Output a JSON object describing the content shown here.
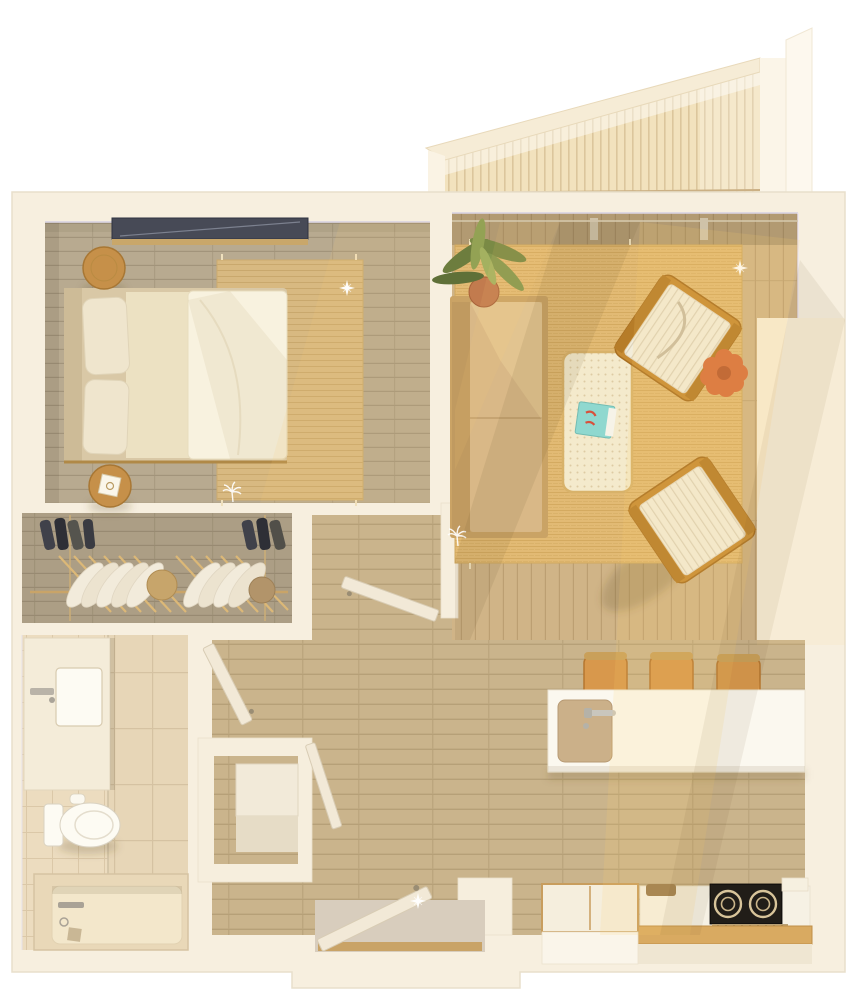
{
  "scene": {
    "kind": "3d-floor-plan-render",
    "view": "top-down",
    "subject": "one-bedroom apartment with balcony",
    "background": "#ffffff",
    "lighting": "warm sunlight from upper-right casting diagonal beams and long chair shadows",
    "decals": [
      "sparkle-stars",
      "palm-tree-glyph"
    ]
  },
  "palette": {
    "wall": "#f7efdf",
    "wall_edge": "#e6ddc9",
    "wall_shadow_lavender": "#d9d3e2",
    "balcony_deck": "#f2e2bd",
    "bedroom_floor": "#b8aa90",
    "hall_floor": "#cab48c",
    "living_floor": "#d0b487",
    "bedroom_rug": "#d8b981",
    "living_rug": "#e2ba74",
    "bath_tile": "#ecdcbf",
    "bed_duvet": "#f8f2df",
    "bed_pillow": "#efe5cd",
    "bed_frame": "#d9c8a6",
    "sofa": "#d9b887",
    "sofa_back": "#c09a60",
    "coffee_table": "#f4eacc",
    "armchair_frame": "#c78b33",
    "armchair_cushion": "#f2ecd9",
    "side_table_accent": "#d8703d",
    "stool_wood": "#c69049",
    "bar_stool": "#d8984c",
    "island": "#fbf8ef",
    "sink_basin": "#cbb089",
    "counter_wood": "#d9aa61",
    "cooktop": "#211d18",
    "cooktop_ring": "#d8c49a",
    "fridge": "#f5eedd",
    "plant_green": "#7a8a45",
    "plant_pot": "#c27b4e",
    "book_teal": "#8fd8cf",
    "window_glass": "#474a56",
    "fixture_white": "#fdfbf3",
    "tub": "#e9d8b8",
    "door_leaf": "#f2e9d7",
    "clothes_white": "#f2ebdb",
    "hanger_wood": "#dcb877"
  },
  "rooms": {
    "balcony": {
      "name": "balcony",
      "items": [
        "chevron-slat-wood-deck",
        "parapet-walls"
      ]
    },
    "bedroom": {
      "name": "bedroom",
      "items": [
        "double-bed",
        "headboard",
        "stacked-pillows",
        "duvet",
        "round-stool-nightstand-top",
        "round-stool-nightstand-bottom-with-candle",
        "jute-area-rug",
        "recessed-window",
        "sparkle-decal",
        "palm-decal"
      ]
    },
    "closet": {
      "name": "walk-in-closet",
      "items": [
        "hanging-rod",
        "white-garments-on-hangers",
        "dark-folded-items-left-shelf",
        "dark-folded-items-right-shelf",
        "round-hat-boxes"
      ]
    },
    "bathroom": {
      "name": "bathroom",
      "items": [
        "vanity-counter-with-sink",
        "wall-faucet",
        "toilet",
        "built-in-bathtub",
        "tub-fixtures",
        "large-tile-shower-wall",
        "toilet-paper-roll"
      ]
    },
    "hallway": {
      "name": "entry-hallway",
      "items": [
        "open-entry-door",
        "entry-landing",
        "utility-closet",
        "water-heater",
        "open-bathroom-door",
        "open-bedroom-door",
        "open-utility-door",
        "sparkle-decal"
      ]
    },
    "living_room": {
      "name": "living-room",
      "items": [
        "camel-sofa",
        "potted-palm-plant",
        "cane-coffee-table",
        "teal-book",
        "rattan-armchair-upper",
        "rattan-armchair-lower",
        "orange-scalloped-side-table",
        "jute-area-rug",
        "glass-wall-mullions",
        "sparkle-decal"
      ]
    },
    "kitchen": {
      "name": "kitchen",
      "items": [
        "white-island-counter",
        "island-sink",
        "chrome-faucet",
        "bar-stool-1",
        "bar-stool-2",
        "bar-stool-3",
        "refrigerator-cabinet",
        "wood-top-base-counter",
        "two-burner-cooktop",
        "vent-grill",
        "backsplash-ledge",
        "cutting-board"
      ]
    }
  }
}
